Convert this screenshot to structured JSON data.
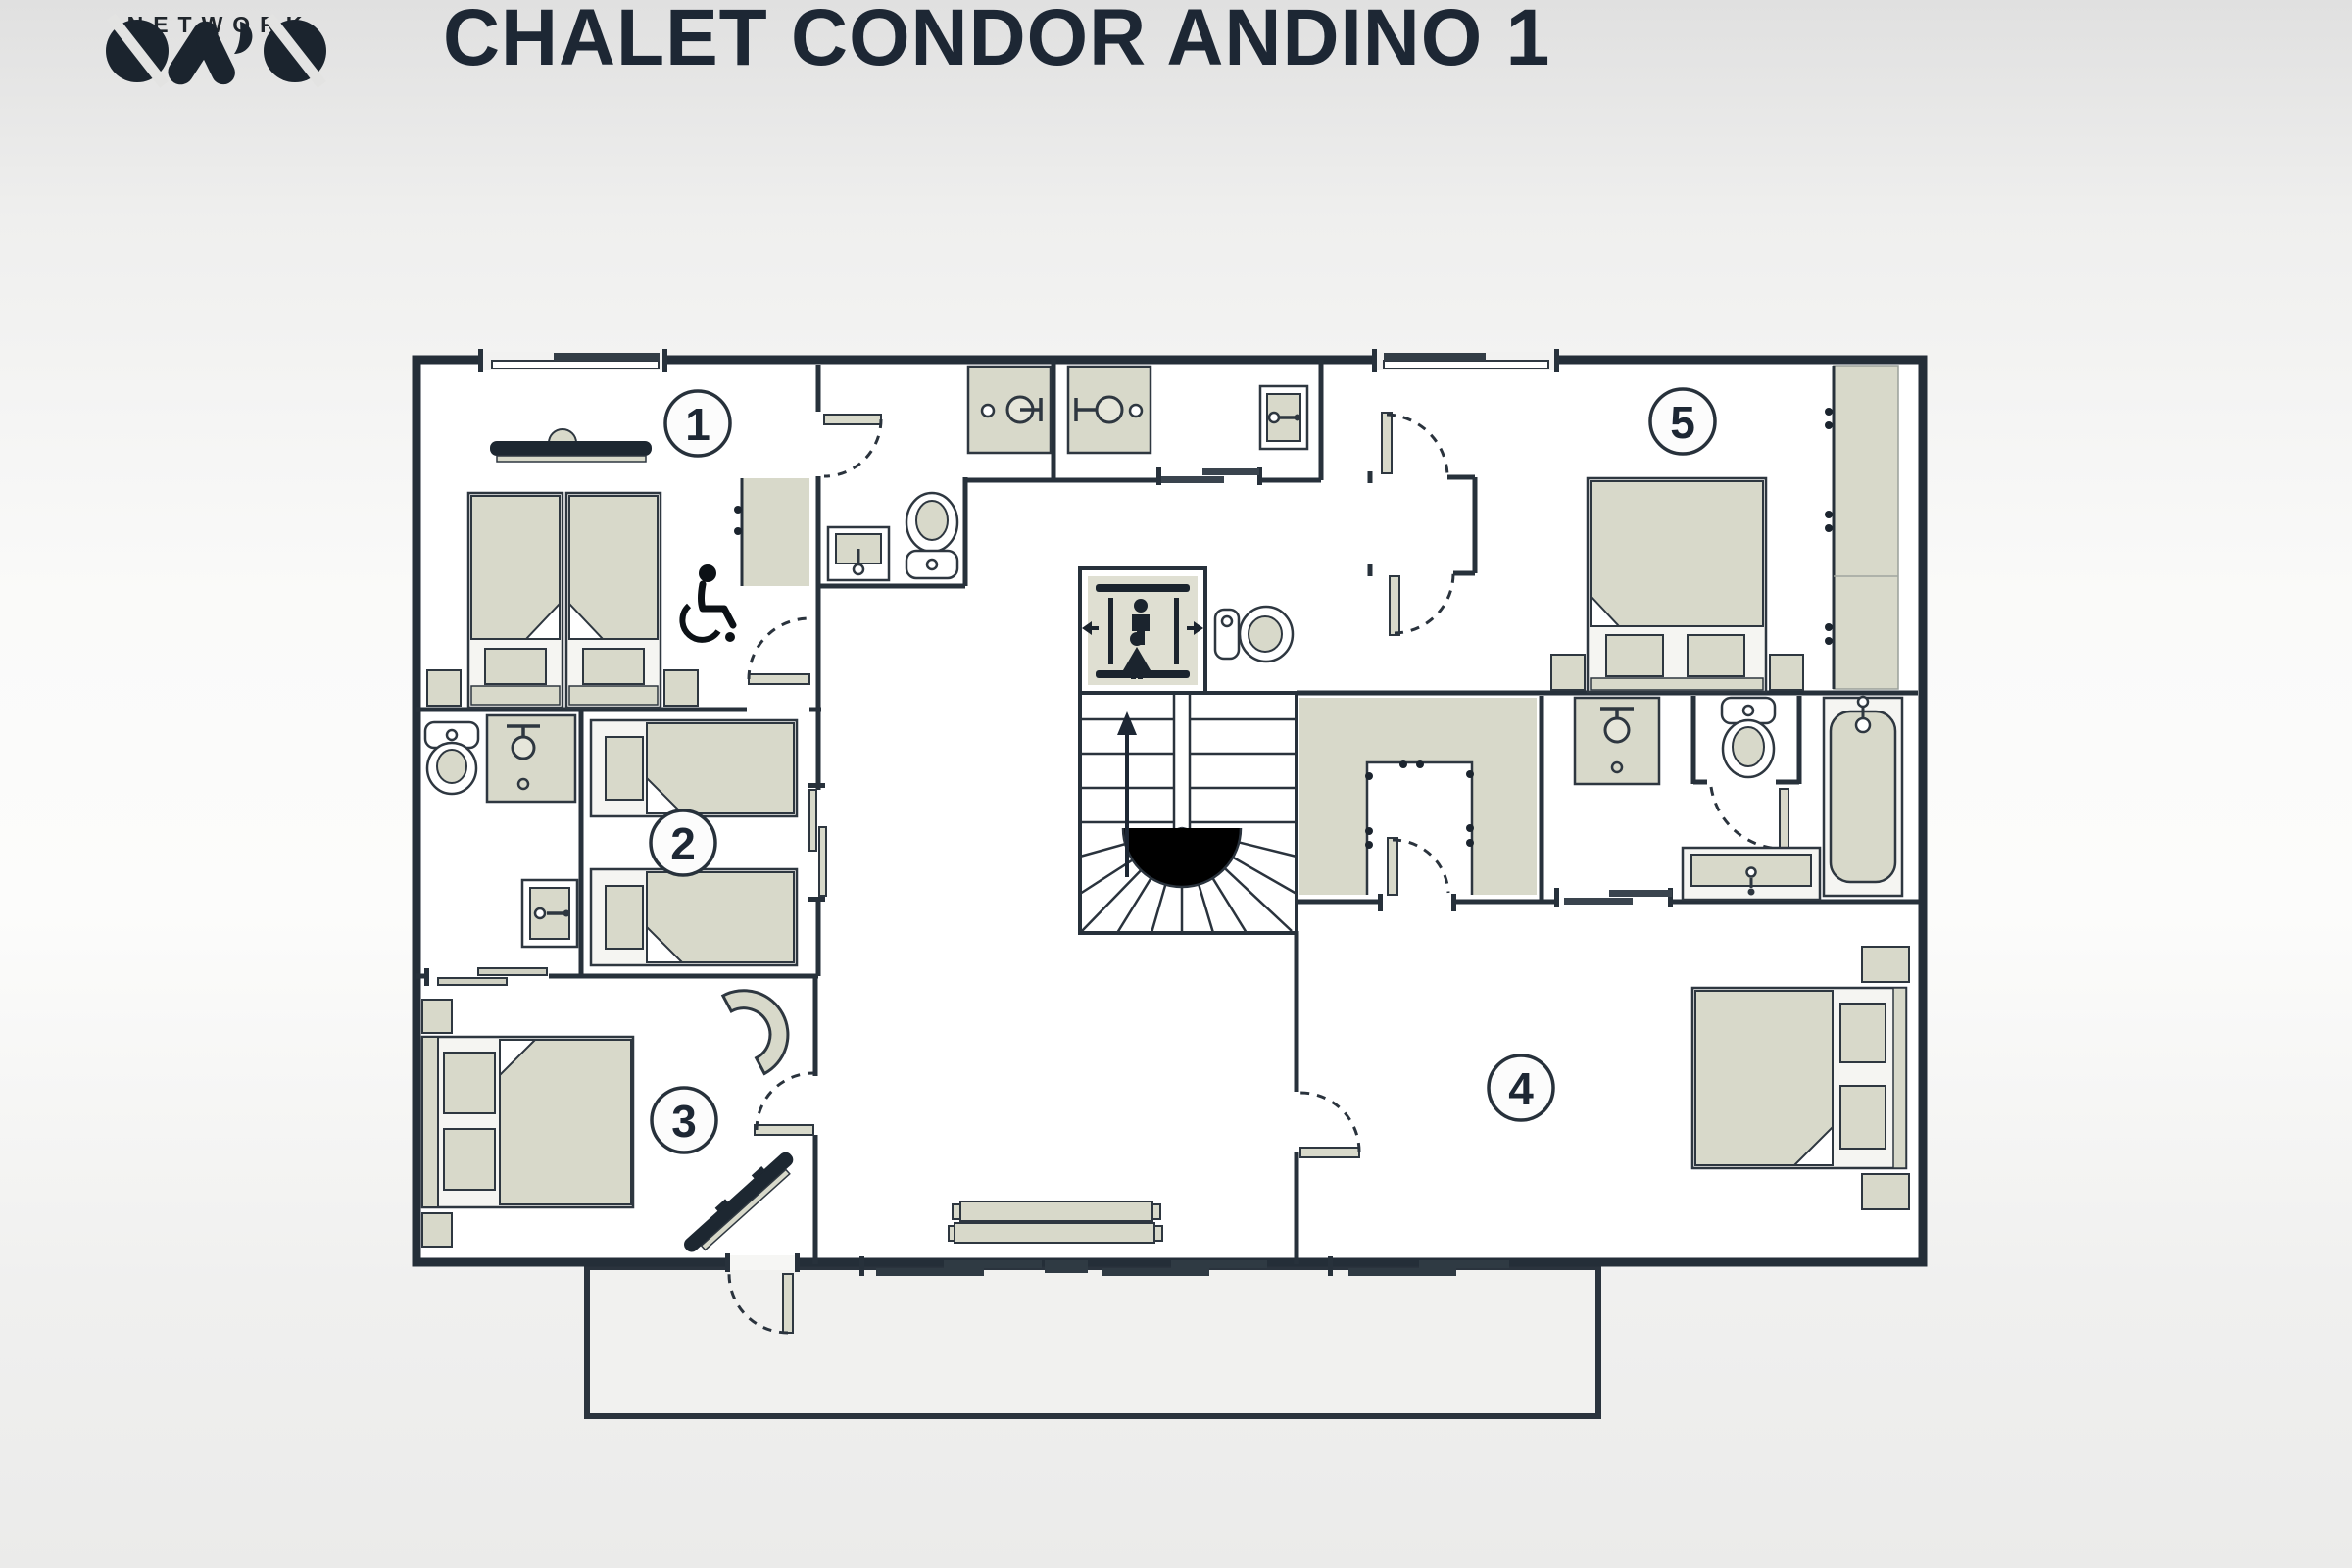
{
  "header": {
    "title": "CHALET CONDOR ANDINO 1",
    "logo": {
      "brand": "OVO",
      "subtitle": "NETWORK"
    }
  },
  "floorplan": {
    "rooms": [
      {
        "id": 1,
        "number": "1"
      },
      {
        "id": 2,
        "number": "2"
      },
      {
        "id": 3,
        "number": "3"
      },
      {
        "id": 4,
        "number": "4"
      },
      {
        "id": 5,
        "number": "5"
      }
    ],
    "icons": [
      "single-bed",
      "twin-bed",
      "double-bed",
      "toilet",
      "sink",
      "vanity-sink",
      "shower",
      "bathtub",
      "wardrobe",
      "walk-in-closet",
      "elevator",
      "staircase-up",
      "wheelchair-accessible",
      "bench",
      "desk-chair",
      "radiator",
      "hinged-door",
      "sliding-door",
      "window",
      "terrace"
    ],
    "colors": {
      "wall": "#27313b",
      "furniture_fill": "#d8d9ca",
      "room_fill": "#ffffff",
      "terrace_fill": "#f1f1ef",
      "accent_dark": "#1b242e",
      "circle_fill": "#fcfcfc"
    }
  }
}
